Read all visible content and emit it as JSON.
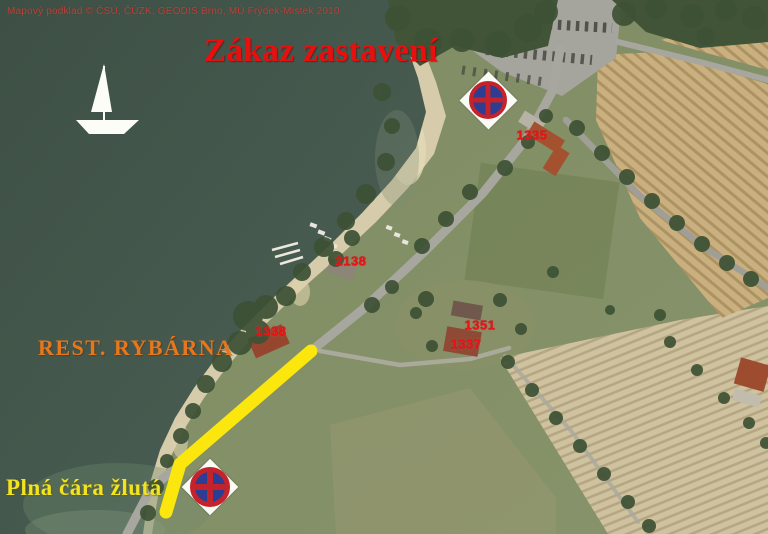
{
  "map": {
    "copyright": "Mapový podklad © ČSÚ, ČÚZK, GEODIS Brno, MÚ Frýdek-Místek 2010",
    "title": "Zákaz zastavení",
    "labels": {
      "restaurant": "REST. RYBÁRNA",
      "yellow_line": "Plná čára žlutá"
    },
    "parcels": [
      "1335",
      "2138",
      "1338",
      "1351",
      "1337"
    ],
    "icons": {
      "no_stopping_sign": "no-stopping traffic sign (blue circle, red ring, red cross) on white diamond",
      "sailboat": "white sailboat pictogram on water"
    },
    "colors": {
      "title_red": "#e80f0f",
      "parcel_red": "#f01414",
      "restaurant_orange": "#e8761c",
      "yellow": "#f3e41c",
      "yellow_line": "#fbe70d",
      "water_green": "#44564b",
      "sign_blue": "#2c3d92",
      "sign_red": "#c5232b"
    }
  }
}
